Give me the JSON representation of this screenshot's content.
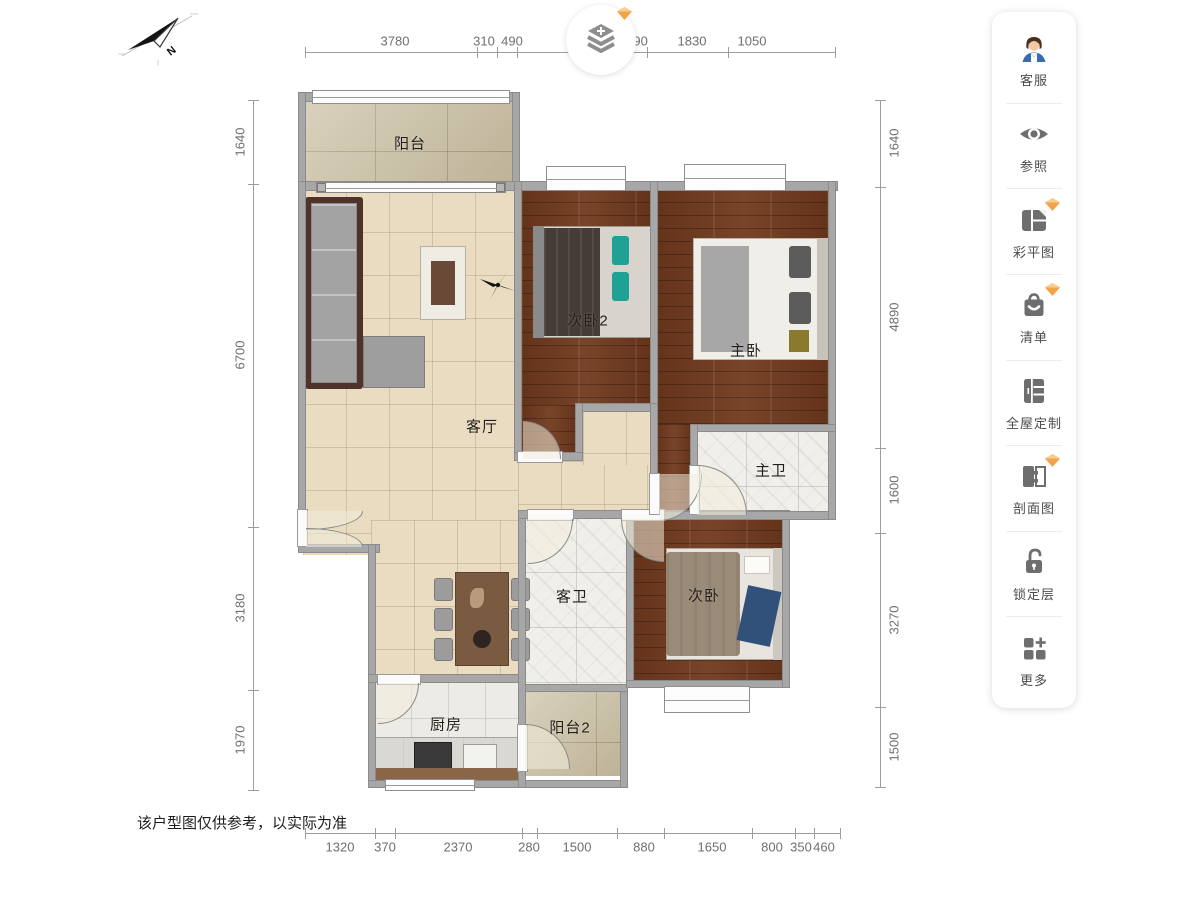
{
  "plan": {
    "rooms": {
      "balcony": "阳台",
      "bedroom2": "次卧2",
      "master_bedroom": "主卧",
      "living_room": "客厅",
      "master_bath": "主卫",
      "guest_bath": "客卫",
      "bedroom": "次卧",
      "kitchen": "厨房",
      "balcony2": "阳台2"
    },
    "compass_label": "N",
    "disclaimer": "该户型图仅供参考，以实际为准",
    "dimensions": {
      "top": [
        "3780",
        "310",
        "490",
        "400",
        "490",
        "1830",
        "1050"
      ],
      "bottom": [
        "1320",
        "370",
        "2370",
        "280",
        "1500",
        "880",
        "1650",
        "800",
        "350",
        "460"
      ],
      "left": [
        "1640",
        "6700",
        "3180",
        "1970"
      ],
      "right": [
        "1640",
        "4890",
        "1600",
        "3270",
        "1500"
      ]
    }
  },
  "sidebar": {
    "items": [
      {
        "label": "客服",
        "icon": "customer-service-icon",
        "premium": false
      },
      {
        "label": "参照",
        "icon": "eye-icon",
        "premium": false
      },
      {
        "label": "彩平图",
        "icon": "color-plan-icon",
        "premium": true
      },
      {
        "label": "清单",
        "icon": "shopping-bag-icon",
        "premium": true
      },
      {
        "label": "全屋定制",
        "icon": "wardrobe-icon",
        "premium": false
      },
      {
        "label": "剖面图",
        "icon": "section-view-icon",
        "premium": true
      },
      {
        "label": "锁定层",
        "icon": "unlock-icon",
        "premium": false
      },
      {
        "label": "更多",
        "icon": "more-grid-icon",
        "premium": false
      }
    ]
  },
  "colors": {
    "wall": "#a7a7a7",
    "wood_floor": "#713a1e",
    "tile_floor": "#e9dcc1",
    "accent_premium": "#f0a449",
    "icon_gray": "#6e6e6e"
  }
}
